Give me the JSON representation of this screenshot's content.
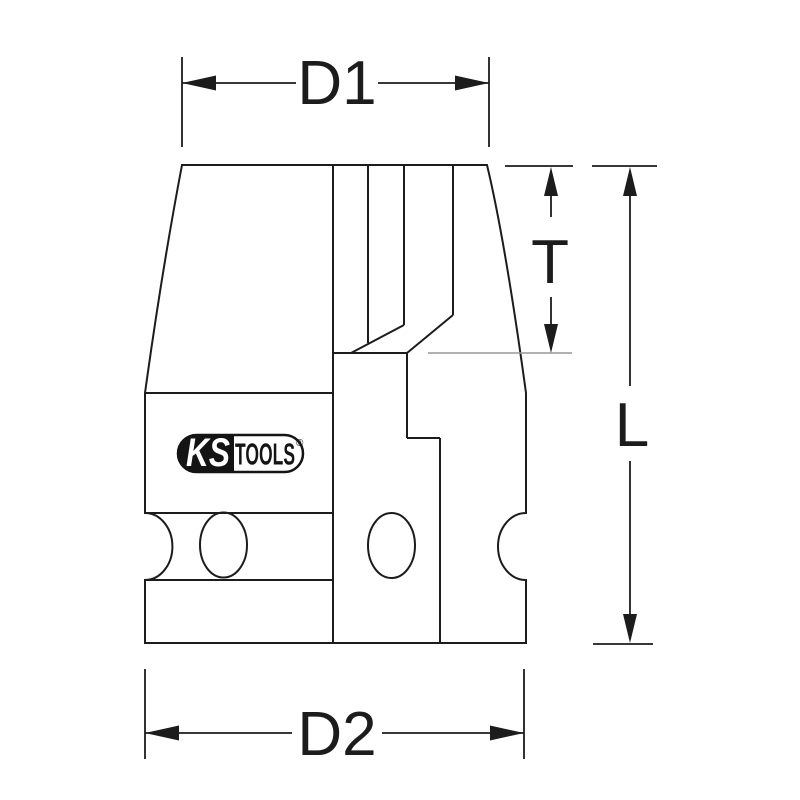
{
  "drawing": {
    "title": "socket-technical-drawing",
    "labels": {
      "d1": "D1",
      "d2": "D2",
      "t": "T",
      "l": "L"
    },
    "logo": {
      "ks": "KS",
      "tools": "TOOLS",
      "registered": "®"
    },
    "colors": {
      "background": "#ffffff",
      "line": "#1c1c1c",
      "extension_light": "#979797",
      "logo_black": "#141414",
      "logo_text_white": "#ffffff"
    }
  }
}
